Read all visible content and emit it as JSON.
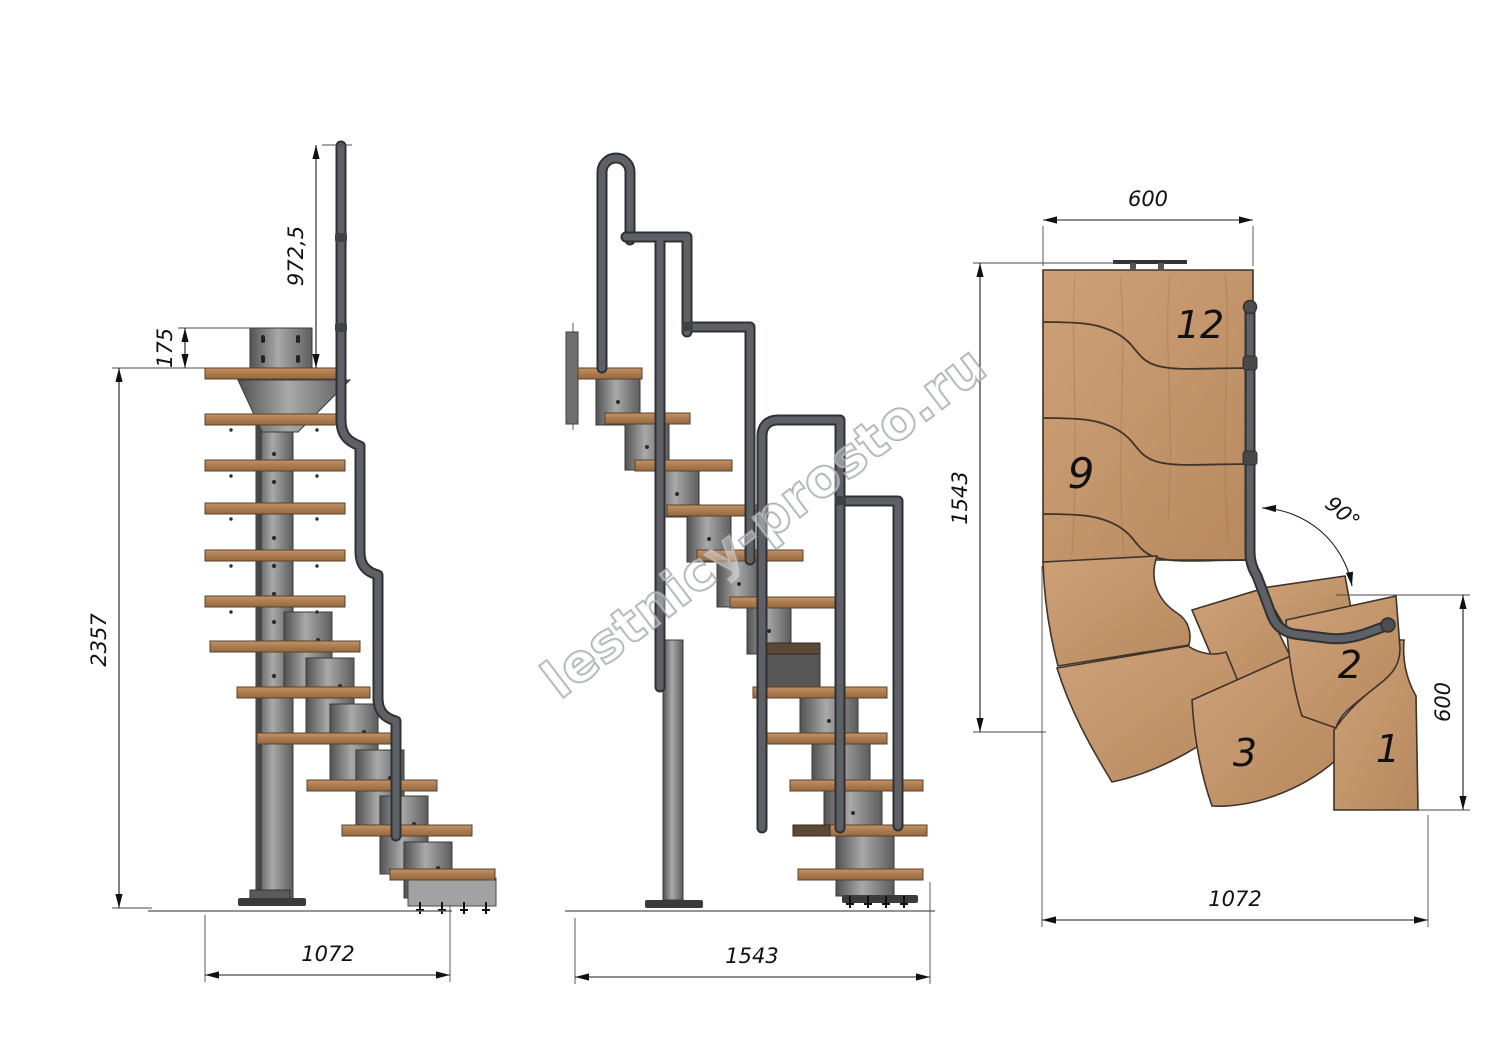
{
  "drawing": {
    "title": "Modular 90-degree staircase technical drawing",
    "watermark": "lestnicy-prosto.ru",
    "palette": {
      "background": "#ffffff",
      "wood_elevation": "#b0835a",
      "wood_plan": "#c79c74",
      "metal_gray": "#7a7a7a",
      "handrail_tube": "#5d6064",
      "dimension_ink": "#1a1a1a",
      "watermark_gray": "#9ba0a5"
    },
    "side_view": {
      "dim_handrail_height": "972,5",
      "dim_bracket_height": "175",
      "dim_total_height": "2357",
      "dim_base_length": "1072"
    },
    "front_view": {
      "dim_base_width": "1543"
    },
    "plan_view": {
      "dim_top_width": "600",
      "dim_side_depth": "1543",
      "dim_entry_depth": "600",
      "dim_overall_width": "1072",
      "angle_label": "90°",
      "steps": {
        "top": "12",
        "mid": "9",
        "third": "3",
        "second": "2",
        "first": "1"
      }
    }
  }
}
